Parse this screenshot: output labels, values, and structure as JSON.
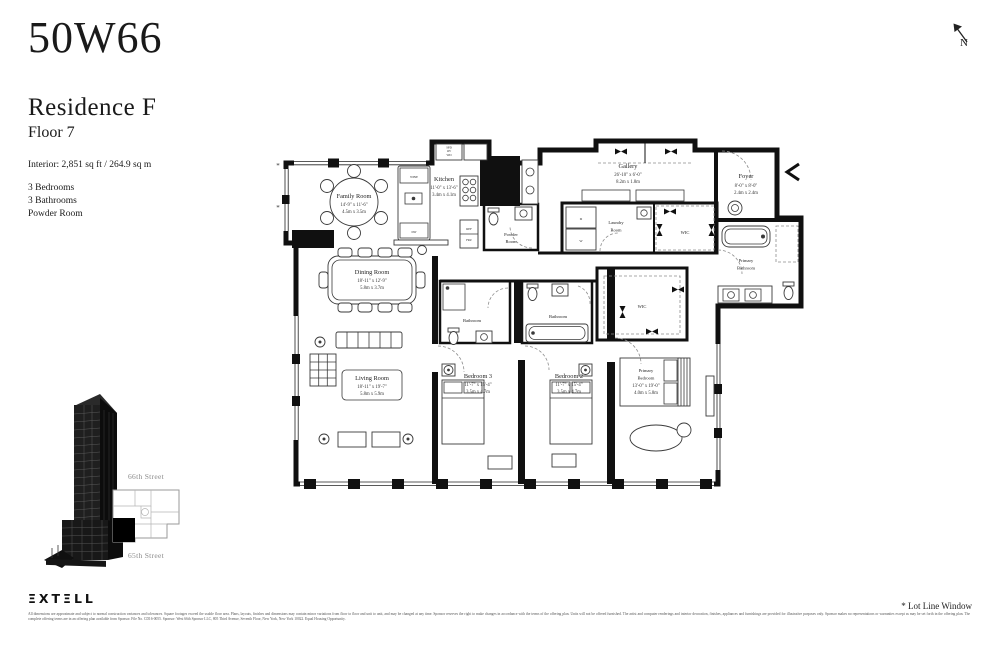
{
  "header": {
    "building": "50W66",
    "residence": "Residence F",
    "floor": "Floor 7"
  },
  "summary": {
    "interior": "Interior: 2,851 sq ft / 264.9 sq m",
    "program": [
      "3 Bedrooms",
      "3 Bathrooms",
      "Powder Room"
    ]
  },
  "compass": {
    "label": "N"
  },
  "plan": {
    "rooms": {
      "family": {
        "name": "Family Room",
        "imperial": "14'-9\" x 11'-6\"",
        "metric": "4.5m x 3.5m"
      },
      "kitchen": {
        "name": "Kitchen",
        "imperial": "11'-0\" x 13'-6\"",
        "metric": "3.4m x 4.1m"
      },
      "powder": {
        "line1": "Powder",
        "line2": "Room"
      },
      "gallery": {
        "name": "Gallery",
        "imperial": "26'-10\" x 6'-0\"",
        "metric": "8.2m x 1.8m"
      },
      "laundry": {
        "line1": "Laundry",
        "line2": "Room"
      },
      "wic_hall": {
        "name": "WIC"
      },
      "wic_primary": {
        "name": "WIC"
      },
      "foyer": {
        "name": "Foyer",
        "imperial": "8'-0\" x 8'-0\"",
        "metric": "2.4m x 2.4m"
      },
      "primary_bath": {
        "line1": "Primary",
        "line2": "Bathroom"
      },
      "bath3": {
        "name": "Bathroom"
      },
      "bath2": {
        "name": "Bathroom"
      },
      "dining": {
        "name": "Dining Room",
        "imperial": "18'-11\" x 12'-9\"",
        "metric": "5.8m x 3.7m"
      },
      "living": {
        "name": "Living Room",
        "imperial": "18'-11\" x 19'-7\"",
        "metric": "5.8m x 5.9m"
      },
      "bedroom3": {
        "name": "Bedroom 3",
        "imperial": "11'-7\" x 15'-4\"",
        "metric": "3.5m x 4.7m"
      },
      "bedroom2": {
        "name": "Bedroom 2",
        "imperial": "11'-7\" x 15'-4\"",
        "metric": "3.5m x 4.7m"
      },
      "primary_bedroom": {
        "line1": "Primary",
        "line2": "Bedroom",
        "imperial": "13'-0\" x 19'-0\"",
        "metric": "4.0m x 5.8m"
      }
    },
    "appliances": {
      "wine": "WINE",
      "dw": "DW",
      "ref1": "REF",
      "ref2": "FRZ",
      "stack": [
        "SPD",
        "OV",
        "WD"
      ],
      "dryer": "D",
      "washer": "W"
    },
    "lot_line_marker": "*"
  },
  "keyplan": {
    "top_street": "66th Street",
    "bottom_street": "65th Street"
  },
  "footer": {
    "brand": "ΞXTΞLL",
    "disclaimer": "All dimensions are approximate and subject to normal construction variances and tolerances. Square footages exceed the usable floor area. Plans, layouts, finishes and dimensions may contain minor variations from floor to floor and unit to unit, and may be changed at any time. Sponsor reserves the right to make changes in accordance with the terms of the offering plan. Units will not be offered furnished. The artist and computer renderings and interior decoration, finishes, appliances and furnishings are provided for illustrative purposes only. Sponsor makes no representations or warranties except as may be set forth in the offering plan. The complete offering terms are in an offering plan available from Sponsor. File No. CD16-0055. Sponsor: West 66th Sponsor LLC, 805 Third Avenue, Seventh Floor, New York, New York 10022. Equal Housing Opportunity.",
    "note": "* Lot Line Window"
  }
}
